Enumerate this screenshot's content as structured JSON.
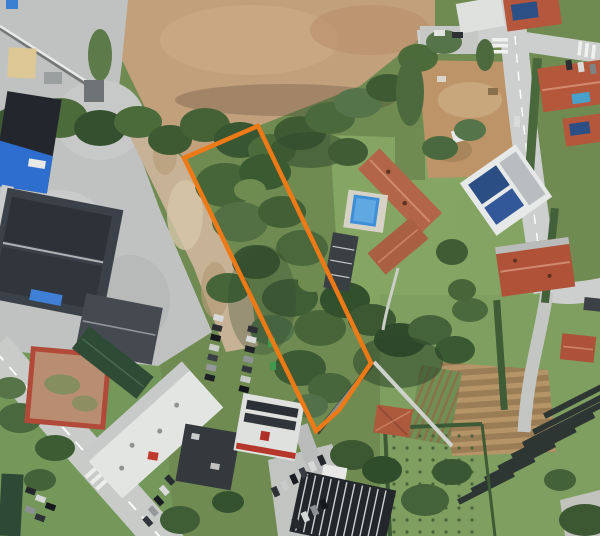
{
  "meta": {
    "view": "aerial-satellite-photo",
    "subject": "land parcel highlighted with orange boundary among woods, industrial lots and residential houses"
  },
  "parcel": {
    "outline_color": "#ED7A17",
    "outline_width": 4.5,
    "points": "258,126 184,158 316,431 339,410 371,363"
  },
  "palette": {
    "vegetation_dark": "#3E5A33",
    "vegetation_mid": "#57713F",
    "grass": "#7C9C5E",
    "lawn": "#85A562",
    "dry_field": "#C3A07C",
    "bare_earth": "#C8B295",
    "concrete": "#BFC2C0",
    "road": "#C9CBC9",
    "dark_roof": "#383D43",
    "white_roof": "#E6E7E5",
    "terracotta_roof": "#B3573B",
    "blue_building": "#2F6FD0",
    "pool_water": "#3F8FD8",
    "solar_panel": "#2C4F86",
    "crop_rows": "#B59468"
  },
  "features": [
    {
      "name": "highlighted-parcel",
      "kind": "boundary-annotation"
    },
    {
      "name": "industrial-warehouses",
      "kind": "buildings"
    },
    {
      "name": "dry-field",
      "kind": "field"
    },
    {
      "name": "wooded-parcel-interior",
      "kind": "vegetation"
    },
    {
      "name": "villa-with-pool",
      "kind": "building"
    },
    {
      "name": "residential-houses",
      "kind": "buildings"
    },
    {
      "name": "construction-lot",
      "kind": "bare-earth"
    },
    {
      "name": "main-road",
      "kind": "road"
    },
    {
      "name": "parking-lots",
      "kind": "vehicles"
    },
    {
      "name": "agricultural-fields",
      "kind": "fields"
    }
  ]
}
